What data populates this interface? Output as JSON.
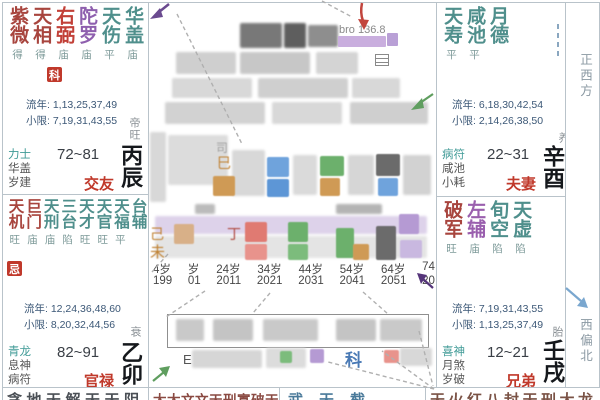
{
  "colors": {
    "main_star": "#a8453e",
    "lucky_star": "#4f8f8c",
    "malefic_star": "#8e5fae",
    "badge_bg": "#c0392b",
    "palace_name": "#c0392b",
    "limits_text": "#3c5877",
    "border": "#b9c3ca",
    "arrow_red": "#c2453d",
    "arrow_green": "#5f9e5f",
    "arrow_purple": "#6a4a8f",
    "arrow_dark_purple": "#55357a",
    "arrow_blue": "#7aa7cf",
    "highlight_purple": "#c9aede",
    "orange_char": "#c08030"
  },
  "compass": {
    "right_top": "正西方",
    "right_bottom": "西偏北"
  },
  "palaces": {
    "top_left": {
      "stars": [
        {
          "chars": "紫微",
          "status": "得",
          "color": "#a8453e"
        },
        {
          "chars": "天相",
          "status": "得",
          "color": "#a8453e"
        },
        {
          "chars": "右弼",
          "status": "庙",
          "color": "#c24038"
        },
        {
          "chars": "陀罗",
          "status": "庙",
          "color": "#8e5fae"
        },
        {
          "chars": "天伤",
          "status": "平",
          "color": "#4f8f8c"
        },
        {
          "chars": "华盖",
          "status": "庙",
          "color": "#4f8f8c"
        }
      ],
      "badge": "科",
      "liunian": "流年: 1,13,25,37,49",
      "xiaoxian": "小限: 7,19,31,43,55",
      "changsheng": "帝旺",
      "gods": [
        "力士",
        "华盖",
        "岁建"
      ],
      "age_range": "72~81",
      "palace_name": "交友",
      "stem_branch": "丙辰"
    },
    "top_right": {
      "stars": [
        {
          "chars": "天寿",
          "status": "平",
          "color": "#4f8f8c"
        },
        {
          "chars": "咸池",
          "status": "平",
          "color": "#4f8f8c"
        },
        {
          "chars": "月德",
          "status": "",
          "color": "#4f8f8c"
        }
      ],
      "liunian": "流年: 6,18,30,42,54",
      "xiaoxian": "小限: 2,14,26,38,50",
      "changsheng": "养",
      "gods": [
        "病符",
        "咸池",
        "小耗"
      ],
      "age_range": "22~31",
      "palace_name": "夫妻",
      "stem_branch": "辛酉"
    },
    "mid_left": {
      "stars": [
        {
          "chars": "天机",
          "status": "旺",
          "color": "#a8453e"
        },
        {
          "chars": "巨门",
          "status": "庙",
          "color": "#a8453e"
        },
        {
          "chars": "天刑",
          "status": "庙",
          "color": "#4f8f8c"
        },
        {
          "chars": "三台",
          "status": "陷",
          "color": "#4f8f8c"
        },
        {
          "chars": "天才",
          "status": "旺",
          "color": "#4f8f8c"
        },
        {
          "chars": "天官",
          "status": "旺",
          "color": "#4f8f8c"
        },
        {
          "chars": "天福",
          "status": "平",
          "color": "#4f8f8c"
        },
        {
          "chars": "台辅",
          "status": "",
          "color": "#4f8f8c"
        }
      ],
      "badge": "忌",
      "liunian": "流年: 12,24,36,48,60",
      "xiaoxian": "小限: 8,20,32,44,56",
      "changsheng": "衰",
      "gods": [
        "青龙",
        "息神",
        "病符"
      ],
      "age_range": "82~91",
      "palace_name": "官禄",
      "stem_branch": "乙卯"
    },
    "mid_right": {
      "stars": [
        {
          "chars": "破军",
          "status": "旺",
          "color": "#a8453e"
        },
        {
          "chars": "左辅",
          "status": "庙",
          "color": "#9a5fae"
        },
        {
          "chars": "旬空",
          "status": "陷",
          "color": "#4f8f8c"
        },
        {
          "chars": "天虚",
          "status": "陷",
          "color": "#4f8f8c"
        }
      ],
      "liunian": "流年: 7,19,31,43,55",
      "xiaoxian": "小限: 1,13,25,37,49",
      "changsheng": "胎",
      "gods": [
        "喜神",
        "月煞",
        "岁破"
      ],
      "age_range": "12~21",
      "palace_name": "兄弟",
      "stem_branch": "壬戌"
    }
  },
  "bottom_row": {
    "cell1": "贪地天解天天阴",
    "cell2": "太太文文天刑寡破天",
    "cell3": "武天截",
    "cell4": "天火红八封天刑大龙"
  },
  "center": {
    "annotation": "bro 136.8",
    "ke": "科",
    "e": "E",
    "si": "司",
    "snake": "巳",
    "ji": "己",
    "wei": "未",
    "ding": "丁",
    "ages": [
      "4岁",
      "岁",
      "24岁",
      "34岁",
      "44岁",
      "54岁",
      "64岁",
      "74"
    ],
    "years": [
      "199",
      "01",
      "2011",
      "2021",
      "2031",
      "2041",
      "2051",
      "20"
    ]
  }
}
